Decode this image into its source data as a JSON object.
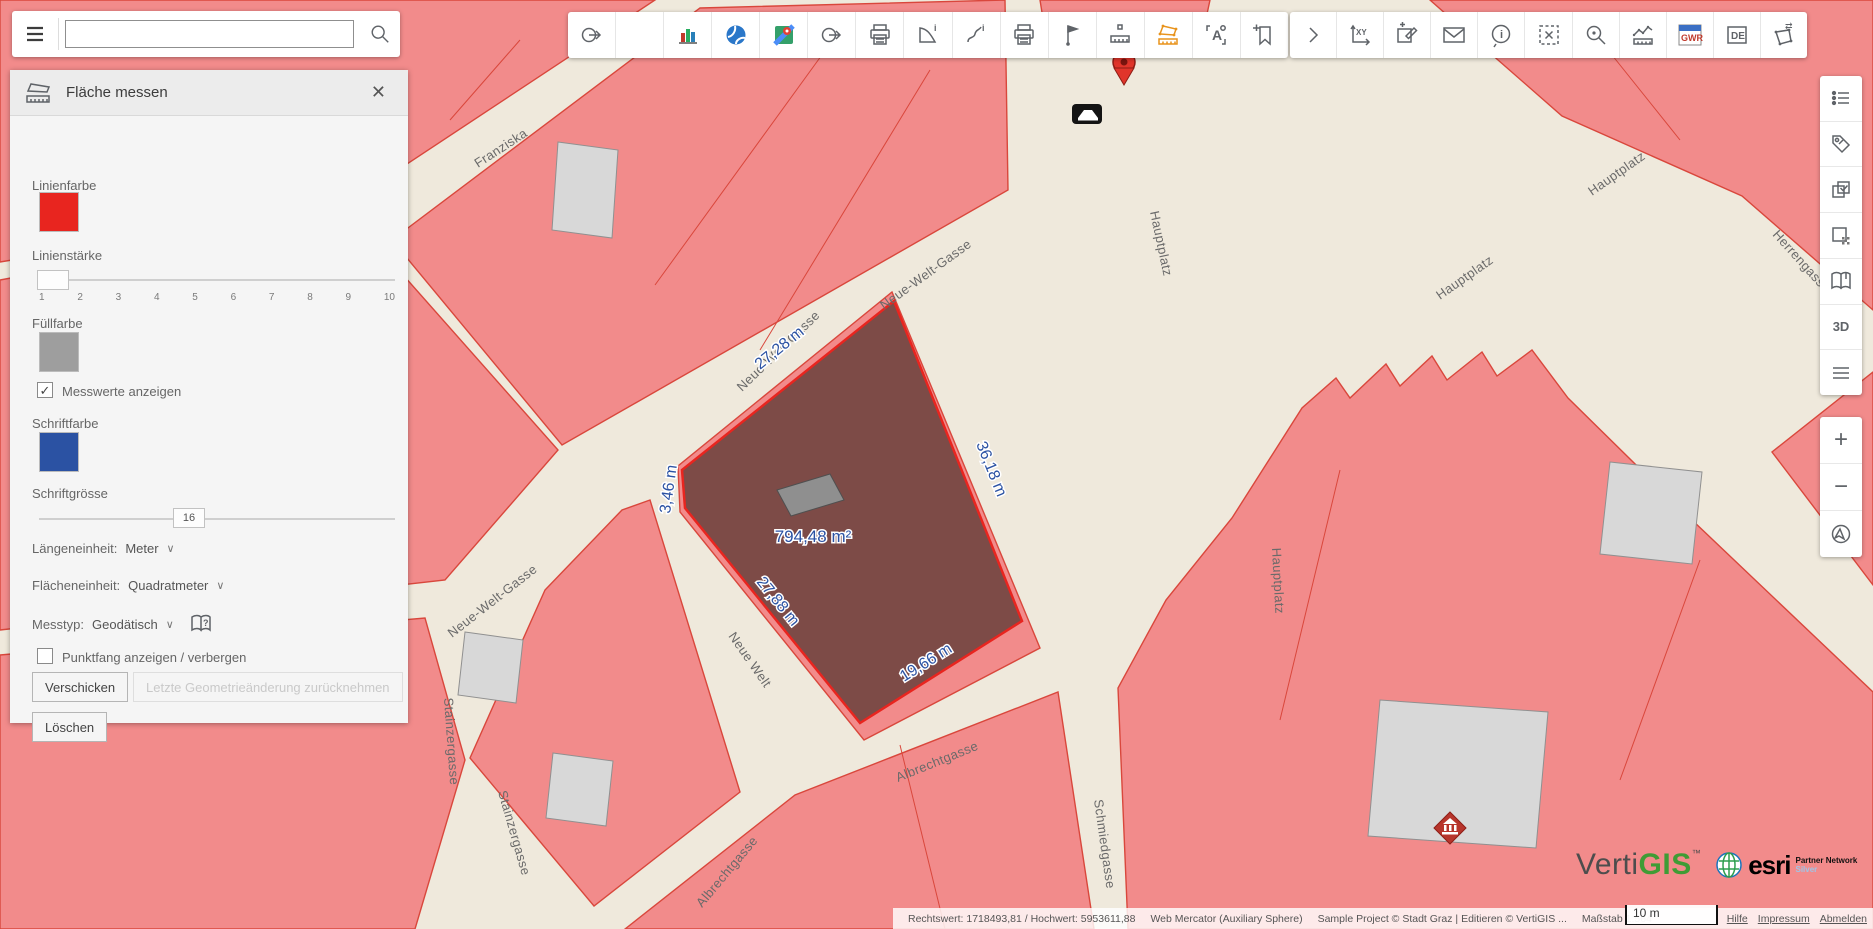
{
  "colors": {
    "accent_orange": "#e8931c",
    "line_red": "#e8251f",
    "fill_gray": "#9e9e9e",
    "font_blue": "#2b52a3",
    "map_block": "#f28b8b",
    "map_block_stroke": "#d9473c",
    "map_bg": "#efe9dc",
    "overlay_fill": "#7d4b47"
  },
  "search": {
    "value": ""
  },
  "panel": {
    "title": "Fläche messen",
    "linienfarbe_label": "Linienfarbe",
    "linienstaerke_label": "Linienstärke",
    "slider_ticks": [
      "1",
      "2",
      "3",
      "4",
      "5",
      "6",
      "7",
      "8",
      "9",
      "10"
    ],
    "fuellfarbe_label": "Füllfarbe",
    "messwerte_label": "Messwerte anzeigen",
    "messwerte_checked": "✓",
    "schriftfarbe_label": "Schriftfarbe",
    "schriftgroesse_label": "Schriftgrösse",
    "schriftgroesse_value": "16",
    "laengeneinheit_label": "Längeneinheit:",
    "laengeneinheit_value": "Meter",
    "flaecheneinheit_label": "Flächeneinheit:",
    "flaecheneinheit_value": "Quadratmeter",
    "messtyp_label": "Messtyp:",
    "messtyp_value": "Geodätisch",
    "punktfang_label": "Punktfang anzeigen / verbergen",
    "verschicken_button": "Verschicken",
    "undo_button": "Letzte Geometrieänderung zurücknehmen",
    "loeschen_button": "Löschen",
    "chevron": "∨"
  },
  "map": {
    "measurements": {
      "side_a": "27,28 m",
      "side_b": "36,18 m",
      "side_c": "19,66 m",
      "side_d": "27,88 m",
      "side_e": "3,46 m",
      "area": "794,48 m²"
    },
    "street_labels": [
      "Franziska",
      "Neue-Welt-Gasse",
      "Neue-Welt-Gasse",
      "Neue-Welt-Gasse",
      "Neue Welt",
      "Hauptplatz",
      "Hauptplatz",
      "Hauptplatz",
      "Hauptplatz",
      "Herrengasse",
      "Albrechtgasse",
      "Albrechtgasse",
      "Schmiedgasse",
      "Stainzergasse",
      "Stainzergasse"
    ]
  },
  "toolbar": {
    "chevron_label": ">",
    "xy_label": "XY",
    "info_i": "i",
    "gwr_label": "GWR",
    "de_label": "DE",
    "transf_arrows": "⇄",
    "a_label": "A"
  },
  "sidebar": {
    "threed_label": "3D",
    "zoom_in": "+",
    "zoom_out": "−"
  },
  "statusbar": {
    "coordinates": "Rechtswert: 1718493,81 / Hochwert: 5953611,88",
    "projection": "Web Mercator (Auxiliary Sphere)",
    "copyright": "Sample Project © Stadt Graz | Editieren © VertiGIS ...",
    "scale_label": "Maßstab 1:564",
    "scalebar_label": "10 m",
    "links": [
      "Hilfe",
      "Impressum",
      "Abmelden"
    ]
  },
  "branding": {
    "verti": "Verti",
    "gis": "GIS",
    "tm": "™",
    "esri": "esri",
    "partner_line1": "Partner Network",
    "partner_line2": "Silver"
  }
}
